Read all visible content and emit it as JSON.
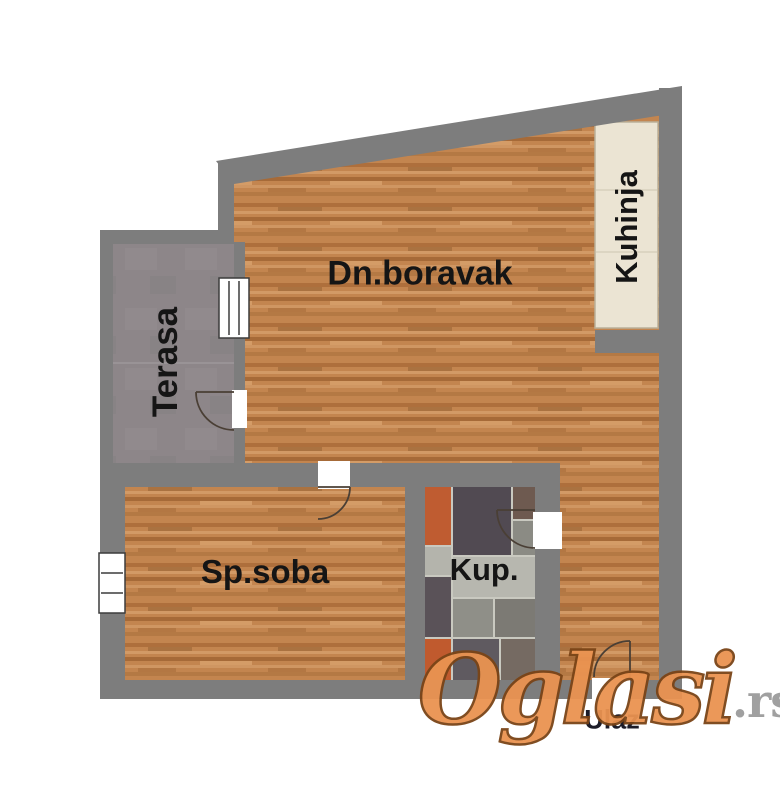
{
  "floorplan": {
    "title": "apartment-floor-plan",
    "rooms": [
      {
        "id": "living",
        "label": "Dn.boravak",
        "floor": "wood"
      },
      {
        "id": "kitchen",
        "label": "Kuhinja",
        "floor": "counter"
      },
      {
        "id": "terrace",
        "label": "Terasa",
        "floor": "concrete"
      },
      {
        "id": "bedroom",
        "label": "Sp.soba",
        "floor": "wood"
      },
      {
        "id": "bathroom",
        "label": "Kup.",
        "floor": "tiles"
      },
      {
        "id": "entrance",
        "label": "Ulaz",
        "floor": "wood"
      }
    ],
    "colors": {
      "wall": "#7d7d7d",
      "wood": "#c3854f",
      "terrace": "#8d8689",
      "counter": "#ebe4d3",
      "tile_orange": "#bf5c31",
      "tile_dark": "#514a52",
      "tile_light": "#b7b7af",
      "label_text": "#151515"
    }
  },
  "watermark": {
    "brand": "Oglasi",
    "tld": ".rs"
  }
}
